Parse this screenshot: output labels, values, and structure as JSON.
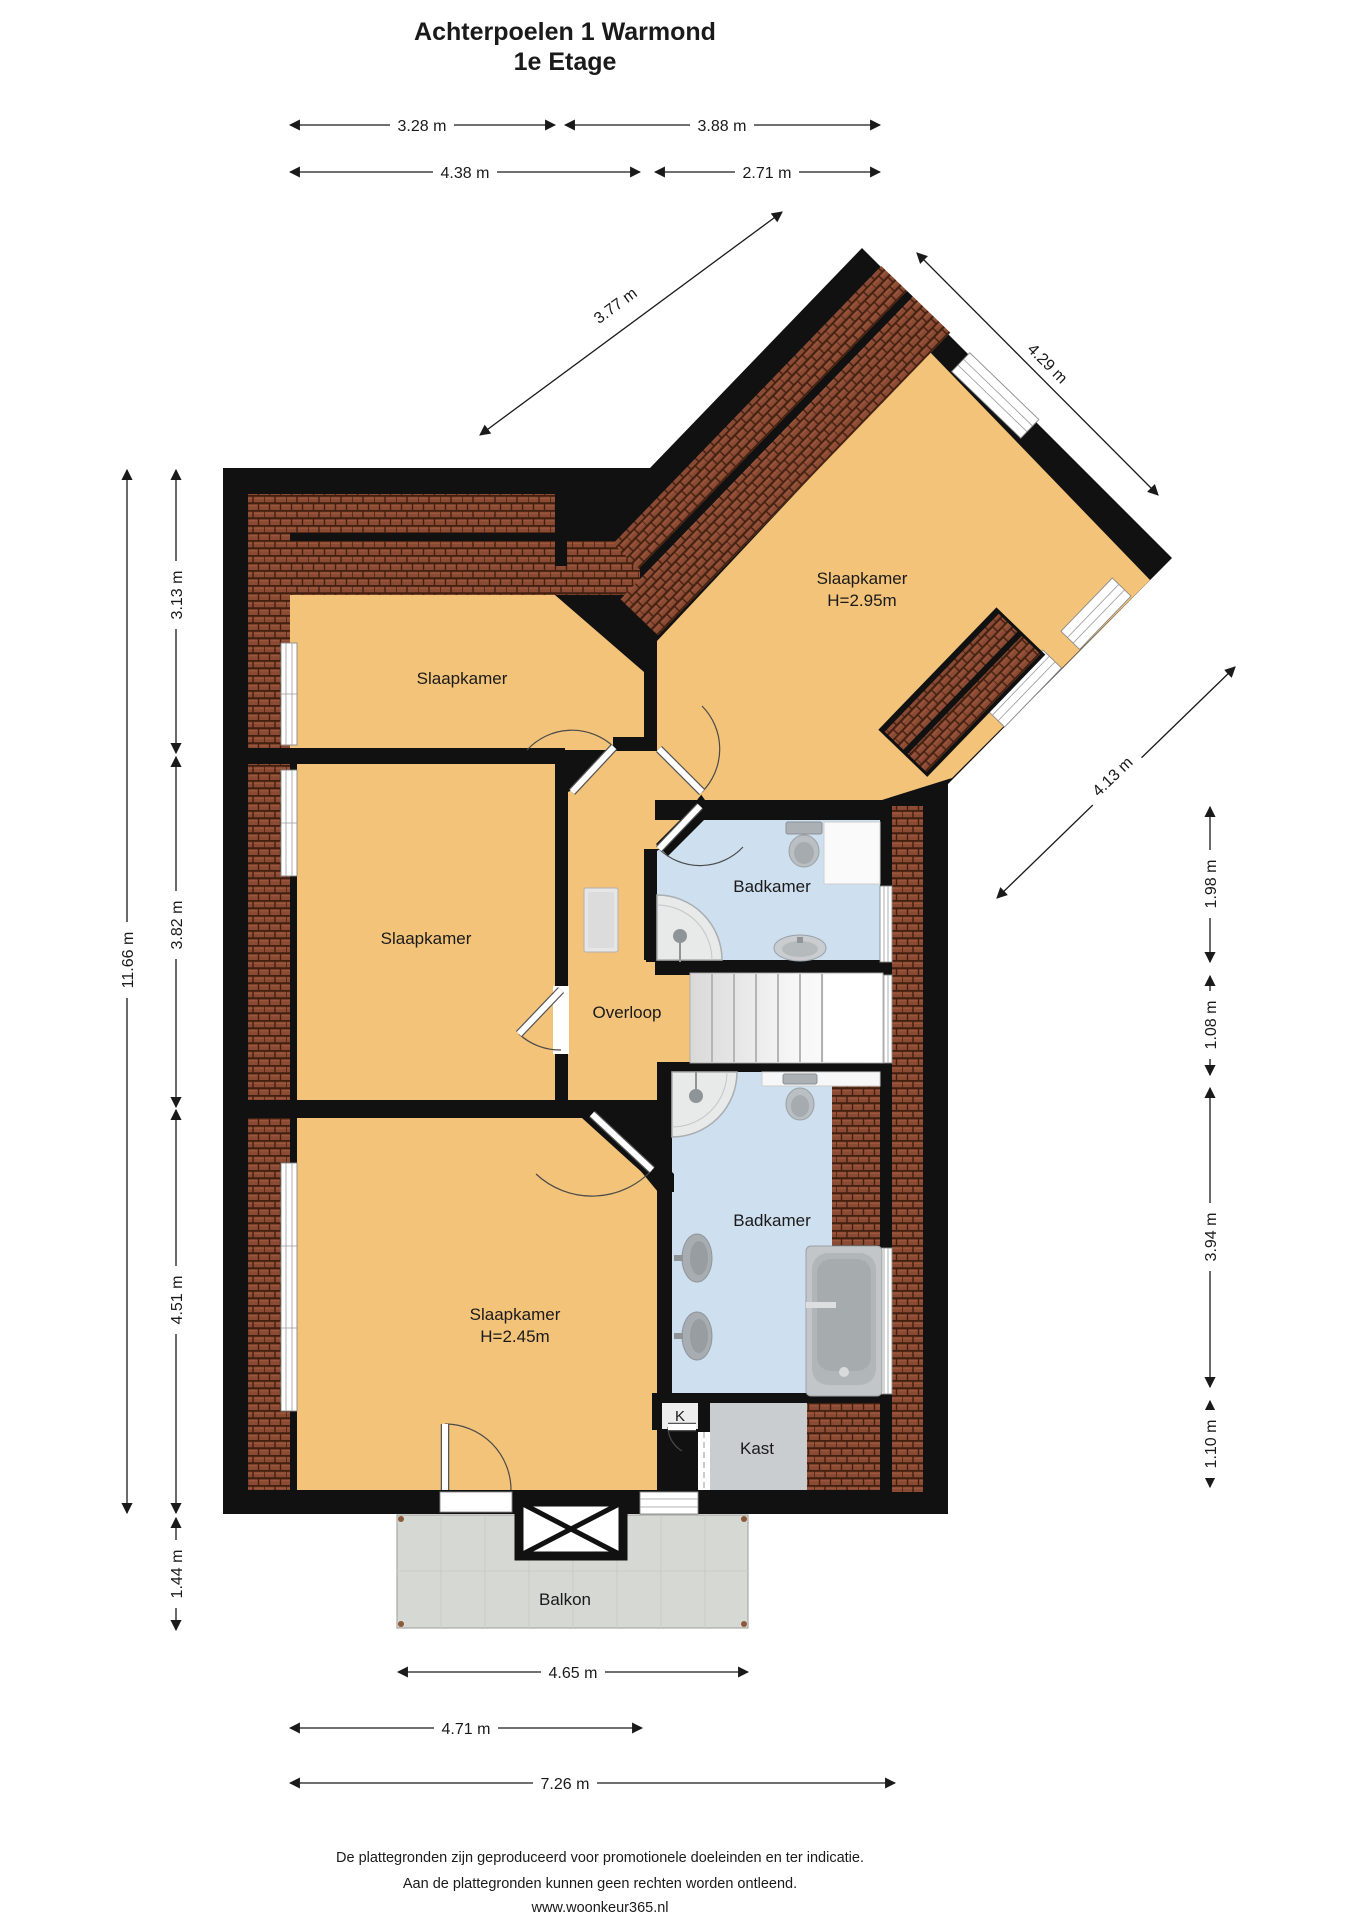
{
  "title": {
    "line1": "Achterpoelen 1  Warmond",
    "line2": "1e Etage"
  },
  "rooms": {
    "slaapkamer_nw": {
      "label": "Slaapkamer"
    },
    "slaapkamer_ne": {
      "label": "Slaapkamer",
      "height": "H=2.95m"
    },
    "slaapkamer_w": {
      "label": "Slaapkamer"
    },
    "slaapkamer_sw": {
      "label": "Slaapkamer",
      "height": "H=2.45m"
    },
    "badkamer_boven": {
      "label": "Badkamer"
    },
    "badkamer_onder": {
      "label": "Badkamer"
    },
    "overloop": {
      "label": "Overloop"
    },
    "kast": {
      "label": "Kast"
    },
    "k_closet": {
      "label": "K"
    },
    "balkon": {
      "label": "Balkon"
    }
  },
  "dimensions": {
    "top_inner_left": "3.28 m",
    "top_inner_right": "3.88 m",
    "top_outer_left": "4.38 m",
    "top_outer_right": "2.71 m",
    "wing_nw": "3.77 m",
    "wing_ne": "4.29 m",
    "wing_se": "4.13 m",
    "left_total": "11.66 m",
    "left_seg1": "3.13 m",
    "left_seg2": "3.82 m",
    "left_seg3": "4.51 m",
    "left_balkon": "1.44 m",
    "right_seg1": "1.98 m",
    "right_seg2": "1.08 m",
    "right_seg3": "3.94 m",
    "right_seg4": "1.10 m",
    "bottom_balkon": "4.65 m",
    "bottom_inner": "4.71 m",
    "bottom_total": "7.26 m"
  },
  "footer": {
    "line1": "De plattegronden zijn geproduceerd voor promotionele doeleinden en ter indicatie.",
    "line2": "Aan de plattegronden kunnen geen rechten worden ontleend.",
    "line3": "www.woonkeur365.nl"
  },
  "colors": {
    "floor": "#F2C379",
    "bathroom": "#CEDFEF",
    "wall": "#111111",
    "roof_tile": "#8A4A34",
    "kast": "#C9CDCF",
    "balkon": "#D6D8D4"
  }
}
